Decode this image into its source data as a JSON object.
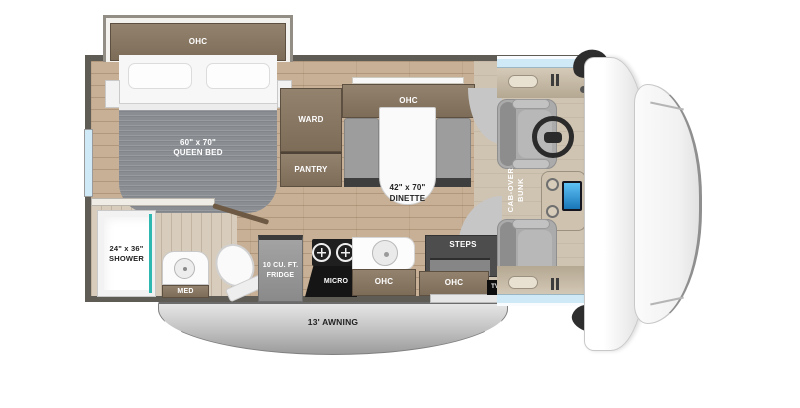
{
  "title": "Class C motorhome floor plan",
  "labels": {
    "bedroom_ohc": "OHC",
    "queen_bed": "60\" x 70\"\nQUEEN BED",
    "ward": "WARD",
    "pantry": "PANTRY",
    "dinette_ohc": "OHC",
    "dinette": "42\" x 70\"\nDINETTE",
    "cab_over_bunk": "CAB-OVER\nBUNK",
    "shower": "24\" x 36\"\nSHOWER",
    "med": "MED",
    "fridge": "10 CU. FT.\nFRIDGE",
    "micro": "MICRO",
    "kitchen_ohc": "OHC",
    "steps": "STEPS",
    "entry_ohc": "OHC",
    "tv": "TV",
    "awning": "13' AWNING"
  },
  "colors": {
    "wall": "#5f5b55",
    "cabinet": "#7d6c58",
    "cabinet_light": "#93826e",
    "floor_wood": "#c7b096",
    "floor_bath": "#d8cdbc",
    "blanket": "#8a8e93",
    "seat_gray": "#9d9d9d",
    "steps_dark": "#4d4d4d",
    "window_glass": "#cfe9f6",
    "shower_teal": "#2fb8b2",
    "screen_blue": "#1976b8",
    "awning_light": "#e6e6e6",
    "awning_dark": "#9b9b9b",
    "dash_beige": "#d5cab8"
  }
}
